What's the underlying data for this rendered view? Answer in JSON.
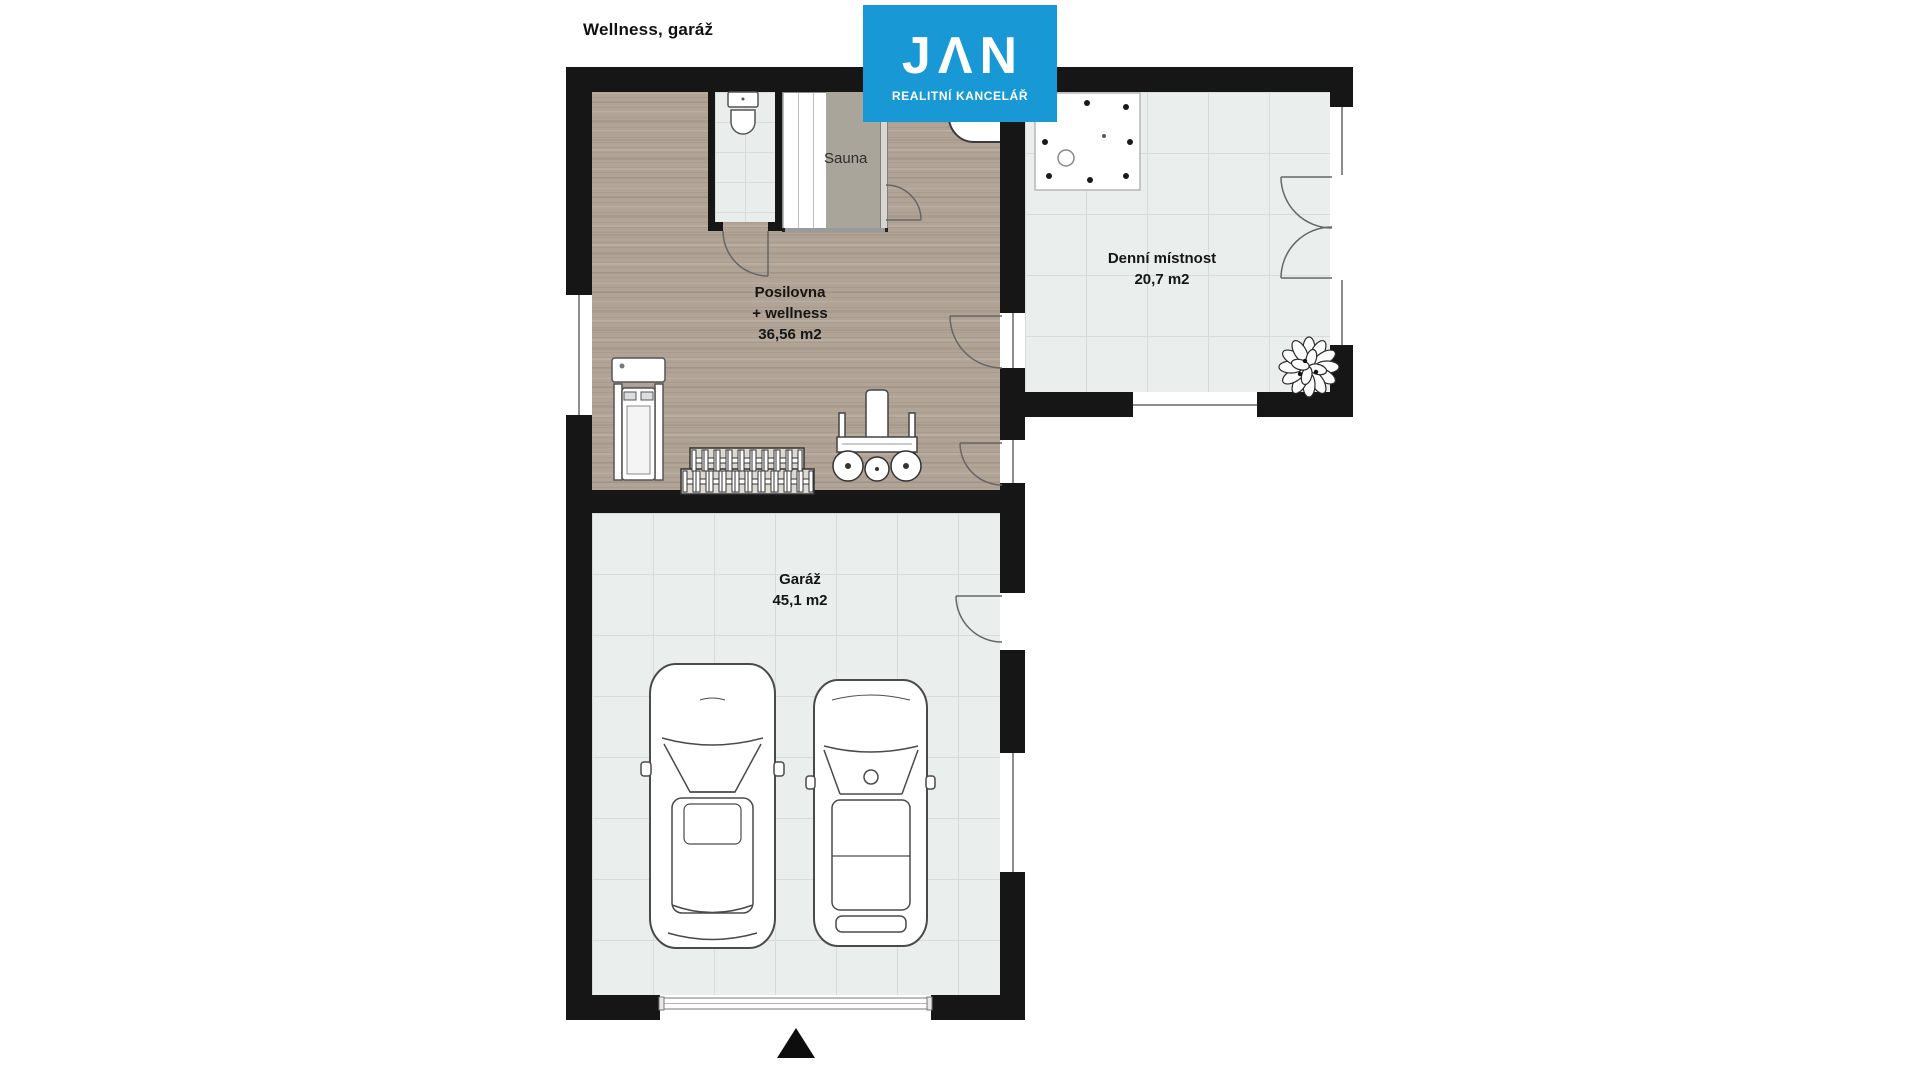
{
  "page": {
    "title": "Wellness, garáž"
  },
  "logo": {
    "brand": "JAN",
    "brand_display": "JΛN",
    "subtitle": "REALITNÍ KANCELÁŘ",
    "bg_color": "#1898d5",
    "style": "background:#1898d5"
  },
  "rooms": {
    "wellness": {
      "name": "Posilovna",
      "name_line2": "+ wellness",
      "area": "36,56 m2"
    },
    "denni": {
      "name": "Denní místnost",
      "area": "20,7 m2"
    },
    "garaz": {
      "name": "Garáž",
      "area": "45,1 m2"
    },
    "sauna": {
      "name": "Sauna"
    }
  },
  "colors": {
    "wall": "#161616",
    "wood_floor": "#b1a496",
    "tile_floor": "#eaeeec",
    "logo_blue": "#1898d5",
    "background": "#ffffff"
  },
  "icons": {
    "north_arrow": "filled-triangle-up",
    "plant": "potted-plant-top-view",
    "hot_tub": "whirlpool-top-view",
    "toilet": "toilet-top-view",
    "shower": "corner-shower",
    "car_large": "suv-top-view",
    "car_small": "hatchback-top-view",
    "treadmill": "treadmill-top-view",
    "dumbbell_rack": "dumbbell-rack-top-view",
    "bench_press": "bench-press-top-view"
  }
}
